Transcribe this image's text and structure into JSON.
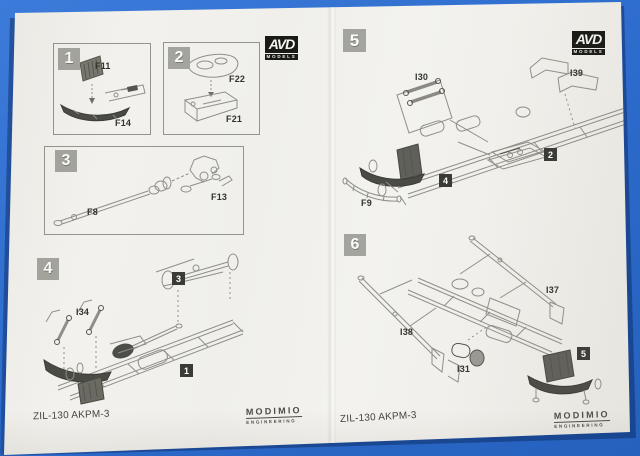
{
  "sheet": {
    "kit_name_left": "ZIL-130 AKPM-3",
    "kit_name_right": "ZIL-130 AKPM-3"
  },
  "brand": {
    "avd": "AVD",
    "avd_sub": "MODELS",
    "publisher": "MODIMIO",
    "publisher_sub": "ENGINEERING"
  },
  "colors": {
    "backdrop_blue": "#2c6acb",
    "paper": "#f1f0ec",
    "step_square_gray": "#a4a49e",
    "assembly_badge_black": "#3a3a37",
    "line_art_gray": "#8f8f88"
  },
  "steps": {
    "s1": {
      "num": "1",
      "parts": [
        "F11",
        "F14"
      ]
    },
    "s2": {
      "num": "2",
      "parts": [
        "F22",
        "F21"
      ]
    },
    "s3": {
      "num": "3",
      "parts": [
        "F8",
        "F13"
      ]
    },
    "s4": {
      "num": "4",
      "parts": [
        "I34"
      ],
      "refs": [
        "3",
        "1"
      ]
    },
    "s5": {
      "num": "5",
      "parts": [
        "I30",
        "I39",
        "F9"
      ],
      "refs": [
        "2",
        "4"
      ]
    },
    "s6": {
      "num": "6",
      "parts": [
        "I37",
        "I38",
        "I31"
      ],
      "refs": [
        "5"
      ]
    }
  }
}
